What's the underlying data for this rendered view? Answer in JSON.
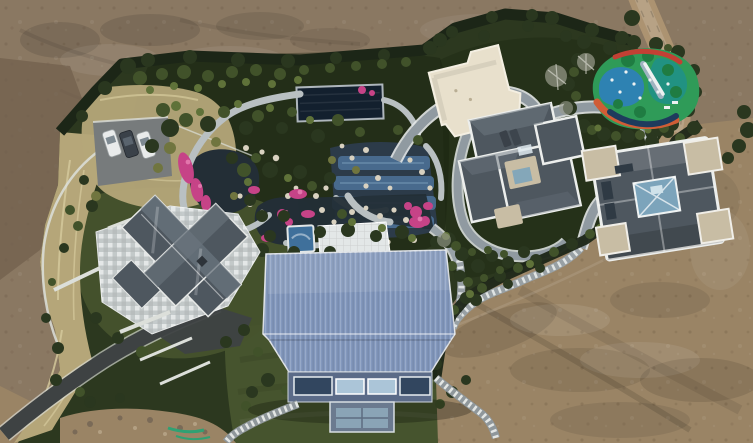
{
  "scene": {
    "type": "aerial-drone-photograph",
    "subject": "Luxury landscaped estate compound surrounded by bare construction dirt",
    "features": {
      "parked_cars": 3,
      "buildings": [
        "west-villa-with-stone-plaza",
        "blue-metal-barn-house",
        "cream-flat-roof-pavilion",
        "center-gray-villa",
        "east-gray-villa"
      ],
      "garden": [
        "koi-ponds",
        "winding-stone-paths",
        "pink-azalea-beds",
        "rock-water-terraces",
        "dark-pool-cover",
        "spa-pool",
        "white-terrace"
      ],
      "playground": "multicolor-rubber-surface-with-slide",
      "boundary": [
        "clipped-hedge",
        "dry-ornamental-grass-bank",
        "dirt-road"
      ]
    }
  },
  "palette": {
    "dirt_base": "#8A7862",
    "dirt_dark": "#71604E",
    "dirt_light": "#9A8465",
    "road_dirt": "#AC9371",
    "hedge_dark": "#1C2617",
    "tree_dark": "#2A371F",
    "tree_mid": "#41522A",
    "tree_light": "#5F7239",
    "tree_olive": "#70753F",
    "tree_gray": "#9A9C8D",
    "grass_lawn": "#46542E",
    "garden_ground": "#2C381F",
    "dry_grass": "#B5A679",
    "dry_grass_light": "#D6CA9D",
    "asphalt": "#3E4243",
    "curb_white": "#DCDFDA",
    "pad_gray": "#777B7C",
    "car_white": "#E9EBEB",
    "car_dark": "#3A4149",
    "stone_path": "#B9C0C2",
    "ribbon_path": "#909AA1",
    "ribbon_casing": "#E3E7E7",
    "pond_water": "#232E36",
    "pool_cover": "#13202E",
    "water_blue": "#4B7095",
    "water_blue_light": "#82A4C1",
    "rock_white": "#D8D1C0",
    "flower_pink": "#C64387",
    "flower_light": "#E276AC",
    "plaza_stone": "#C6CCCD",
    "roof_slate": "#4E575F",
    "roof_slate_light": "#6A747D",
    "roof_white_trim": "#ECEEEC",
    "roof_flat_tan": "#C8BDA4",
    "cream_roof": "#E8E0CC",
    "glass_blue": "#7CA4BB",
    "barn_roof": "#8398BD",
    "barn_facade": "#5B6B88",
    "barn_window": "#ABC5D8",
    "barn_window_dark": "#32465F",
    "spa_blue": "#3F709B",
    "terrace_white": "#E3E7E7",
    "pg_green": "#2F9B58",
    "pg_blue": "#2E81B7",
    "pg_teal": "#1E908A",
    "pg_orange": "#D05D36",
    "pg_red": "#C24034",
    "pg_navy": "#1E3B5D",
    "pg_white": "#EDF1F1",
    "paint_green": "#2FA173"
  }
}
